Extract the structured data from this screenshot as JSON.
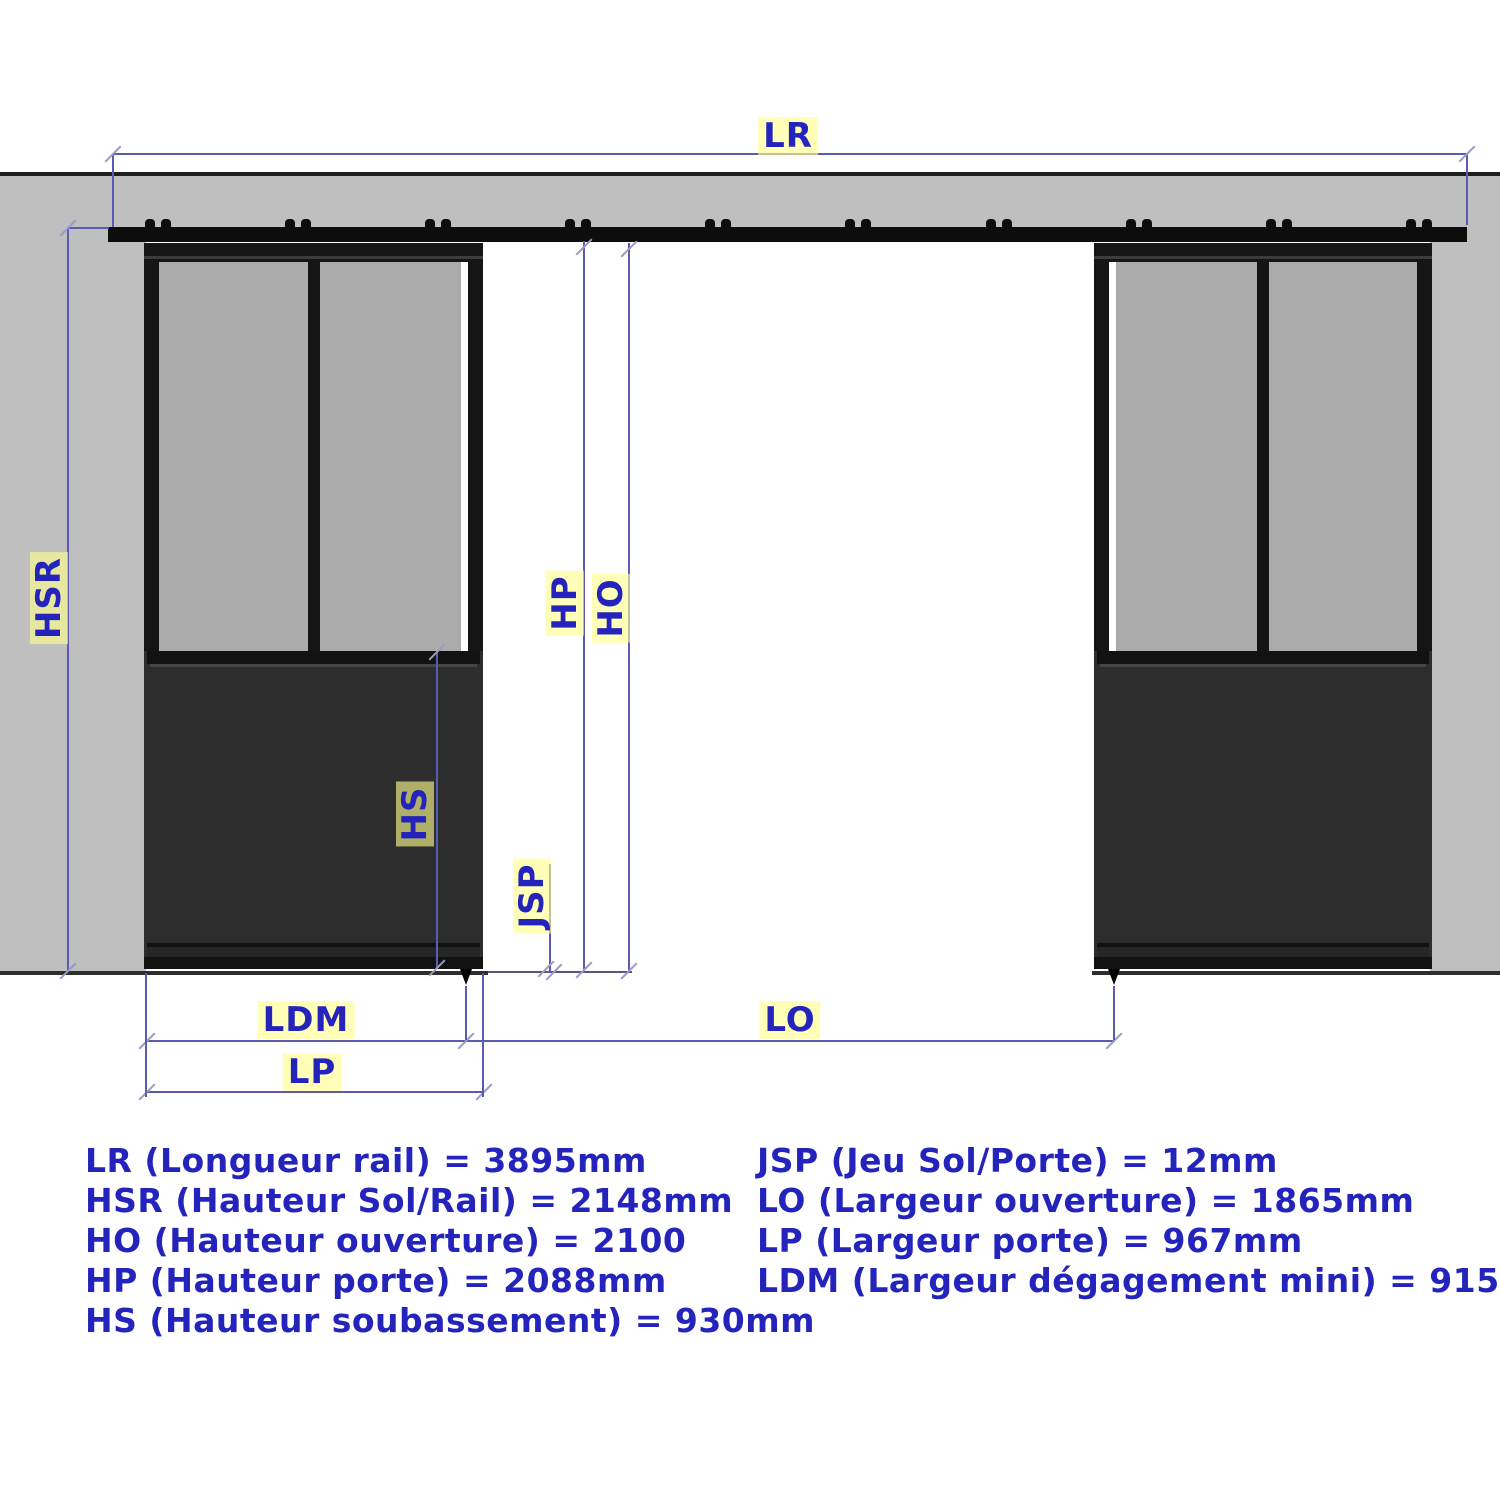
{
  "colors": {
    "dim": "#5b5bb2",
    "tick": "#9a9ac6",
    "txt": "#2424bd",
    "wall": "#bfbfbf",
    "glass": "#ababab",
    "frame": "#151515",
    "panel": "#2d2d2d",
    "floor": "#2e2e2e"
  },
  "diagram": {
    "dimension_labels": {
      "lr": "LR",
      "hsr": "HSR",
      "hp": "HP",
      "ho": "HO",
      "hs": "HS",
      "jsp": "JSP",
      "ldm": "LDM",
      "lo": "LO",
      "lp": "LP"
    }
  },
  "legend": {
    "left_column": [
      "LR (Longueur rail) = 3895mm",
      "HSR (Hauteur Sol/Rail) = 2148mm",
      "HO (Hauteur ouverture) = 2100",
      "HP (Hauteur porte) = 2088mm",
      "HS (Hauteur soubassement) = 930mm"
    ],
    "right_column": [
      "JSP (Jeu Sol/Porte) = 12mm",
      "LO (Largeur ouverture) = 1865mm",
      "LP (Largeur porte) = 967mm",
      "LDM (Largeur dégagement mini) = 915mm"
    ]
  }
}
